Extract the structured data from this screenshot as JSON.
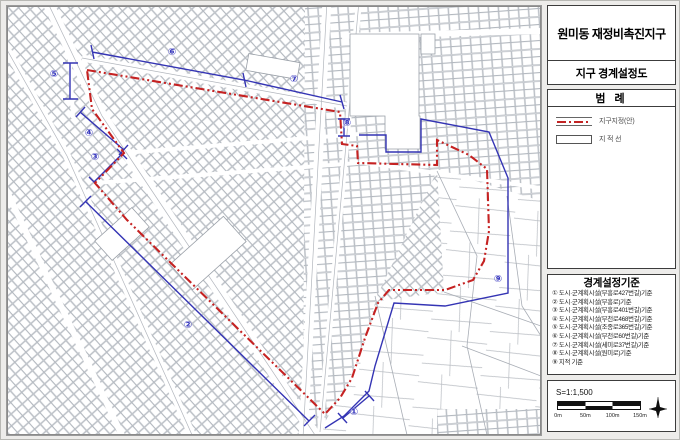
{
  "panel": {
    "title": "원미동 재정비촉진지구",
    "subtitle": "지구 경계설정도",
    "legend": {
      "header": "범 례",
      "items": [
        {
          "name": "district-boundary-line",
          "label": "지구지정(안)",
          "color": "#c22424"
        },
        {
          "name": "cadastral-line",
          "label": "지 적 선",
          "color": "#555555"
        }
      ]
    },
    "criteria": {
      "header": "경계설정기준",
      "items": [
        "① 도시·군계획시설(부흥로427번길)기준",
        "② 도시·군계획시설(부흥로)기준",
        "③ 도시·군계획시설(부흥로401번길)기준",
        "④ 도시·군계획시설(부천로468번길)기준",
        "⑤ 도시·군계획시설(조종로365번길)기준",
        "⑥ 도시·군계획시설(부천로60번길)기준",
        "⑦ 도시·군계획시설(세미로37번길)기준",
        "⑧ 도시·군계획시설(원미로)기준",
        "⑨ 지적 기준"
      ]
    },
    "scale": {
      "label": "S=1:1,500",
      "ticks": [
        "0m",
        "50m",
        "100m",
        "150m"
      ]
    }
  },
  "map": {
    "markers": [
      {
        "label": "①"
      },
      {
        "label": "②"
      },
      {
        "label": "③"
      },
      {
        "label": "④"
      },
      {
        "label": "⑤"
      },
      {
        "label": "⑥"
      },
      {
        "label": "⑦"
      },
      {
        "label": "⑧"
      },
      {
        "label": "⑨"
      }
    ],
    "colors": {
      "district_boundary": "#c52222",
      "dimension_lines": "#3434b4",
      "parcel_lines": "#a8adb5"
    }
  }
}
